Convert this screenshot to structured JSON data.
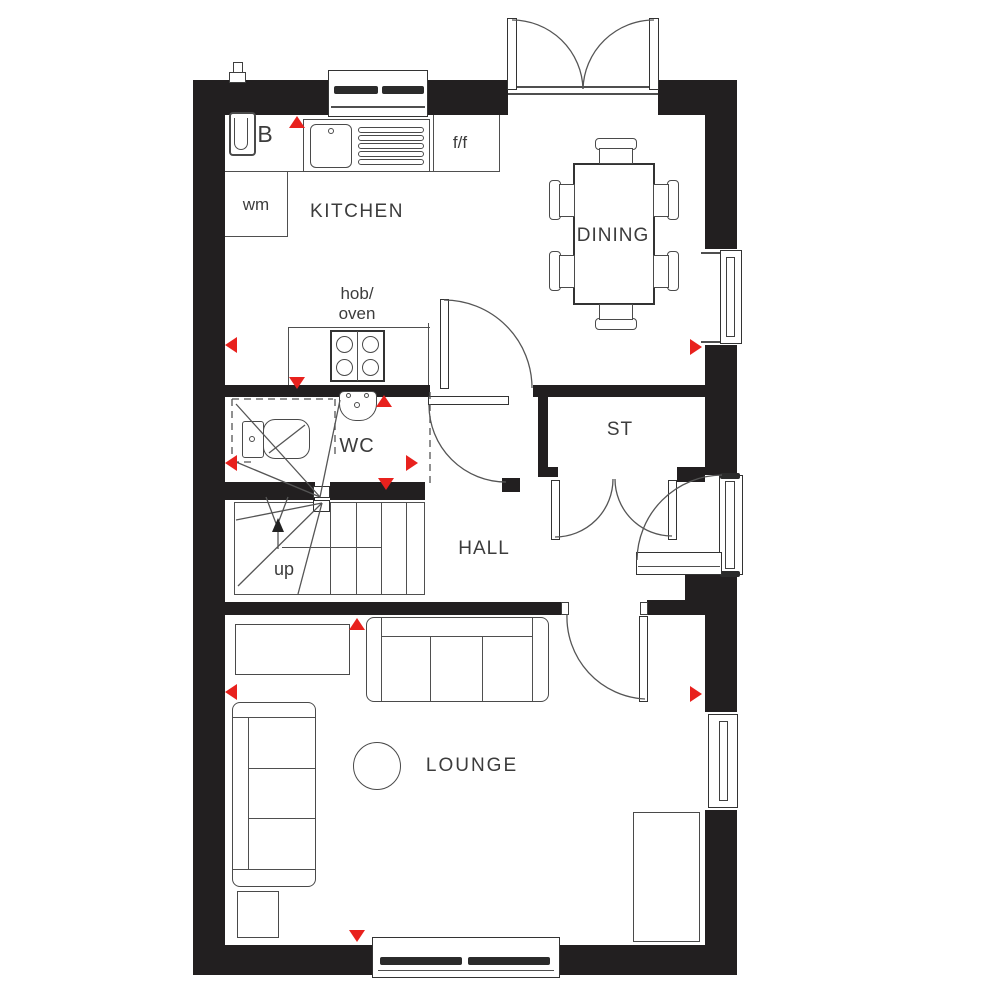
{
  "title": "Ground floor plan",
  "colors": {
    "wall": "#221f20",
    "line": "#555555",
    "marker": "#e8211d",
    "text": "#3c3c3c"
  },
  "rooms": {
    "kitchen": {
      "label": "KITCHEN"
    },
    "dining": {
      "label": "DINING"
    },
    "wc": {
      "label": "WC"
    },
    "hall": {
      "label": "HALL"
    },
    "store": {
      "label": "ST"
    },
    "lounge": {
      "label": "LOUNGE"
    }
  },
  "fixtures": {
    "boiler": "B",
    "fridge_freezer": "f/f",
    "washing_machine": "wm",
    "hob_oven": "hob/\noven",
    "stairs_direction": "up"
  }
}
